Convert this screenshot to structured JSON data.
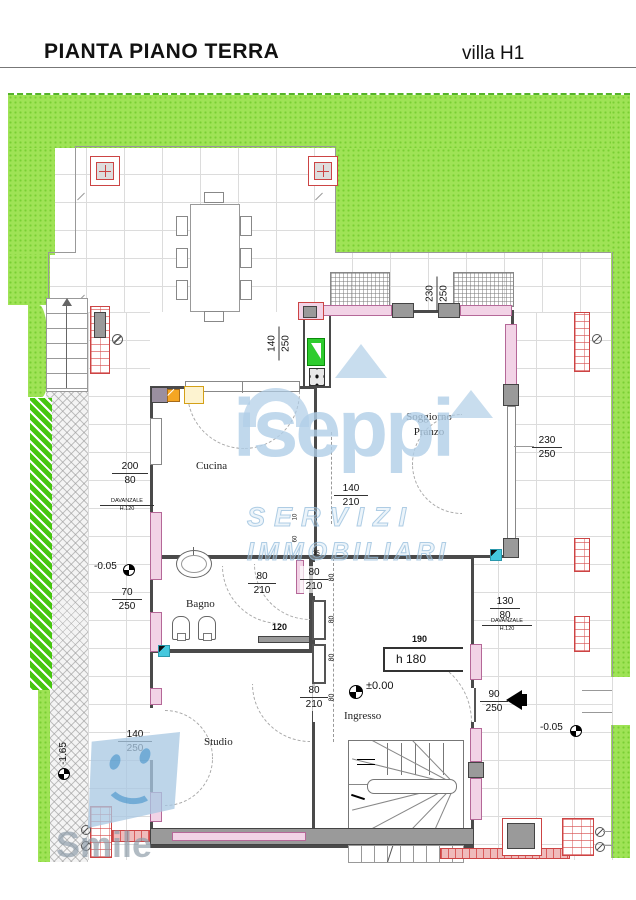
{
  "header": {
    "title": "PIANTA PIANO TERRA",
    "villa": "villa H1"
  },
  "rooms": {
    "cucina": "Cucina",
    "soggiorno1": "Soggiorno",
    "soggiorno2": "Pranzo",
    "bagno": "Bagno",
    "studio": "Studio",
    "ingresso": "Ingresso"
  },
  "dims": {
    "top_window": {
      "a": "230",
      "b": "250"
    },
    "kitchen_window": {
      "a": "140",
      "b": "250"
    },
    "west_window": {
      "a": "200",
      "b": "80"
    },
    "west_sill": {
      "a": "DAVANZALE",
      "b": "H.120"
    },
    "west_window2": {
      "a": "70",
      "b": "250"
    },
    "kitchen_pass": {
      "a": "140",
      "b": "210"
    },
    "bagno_door": {
      "a": "80",
      "b": "210"
    },
    "hall_door1": {
      "a": "80",
      "b": "210"
    },
    "hall_door2": {
      "a": "80",
      "b": "210"
    },
    "wall120": "120",
    "wall35": "35",
    "wall10": "10",
    "wall60": "60",
    "wall80": "80",
    "east_window": {
      "a": "230",
      "b": "250"
    },
    "east_window2": {
      "a": "130",
      "b": "80"
    },
    "east_sill": {
      "a": "DAVANZALE",
      "b": "H.120"
    },
    "niche_width": "190",
    "niche_height": "h 180",
    "entry_door": {
      "a": "90",
      "b": "250"
    },
    "studio_window": {
      "a": "140",
      "b": "250"
    },
    "level_zero": "±0.00",
    "level_patio_left": "-0.05",
    "level_patio_right": "-0.05",
    "level_drive": "-1.65"
  },
  "watermarks": {
    "brand": "iseppi",
    "tag1": "SERVIZI",
    "tag2": "IMMOBILIARI",
    "agency": "Smile"
  },
  "colors": {
    "lawn": "#9fe356",
    "lawn_dot": "#79cf33",
    "tile_line": "#dcdcdc",
    "wall": "#4a4a4a",
    "window_fill": "#f2d3e6",
    "window_edge": "#b56898",
    "masonry_red": "#cc4444",
    "appliance_green": "#2ecc2e",
    "appliance_orange": "#f5a623",
    "downspout_cyan": "#45c8de",
    "watermark_blue": "#b0cee7"
  }
}
